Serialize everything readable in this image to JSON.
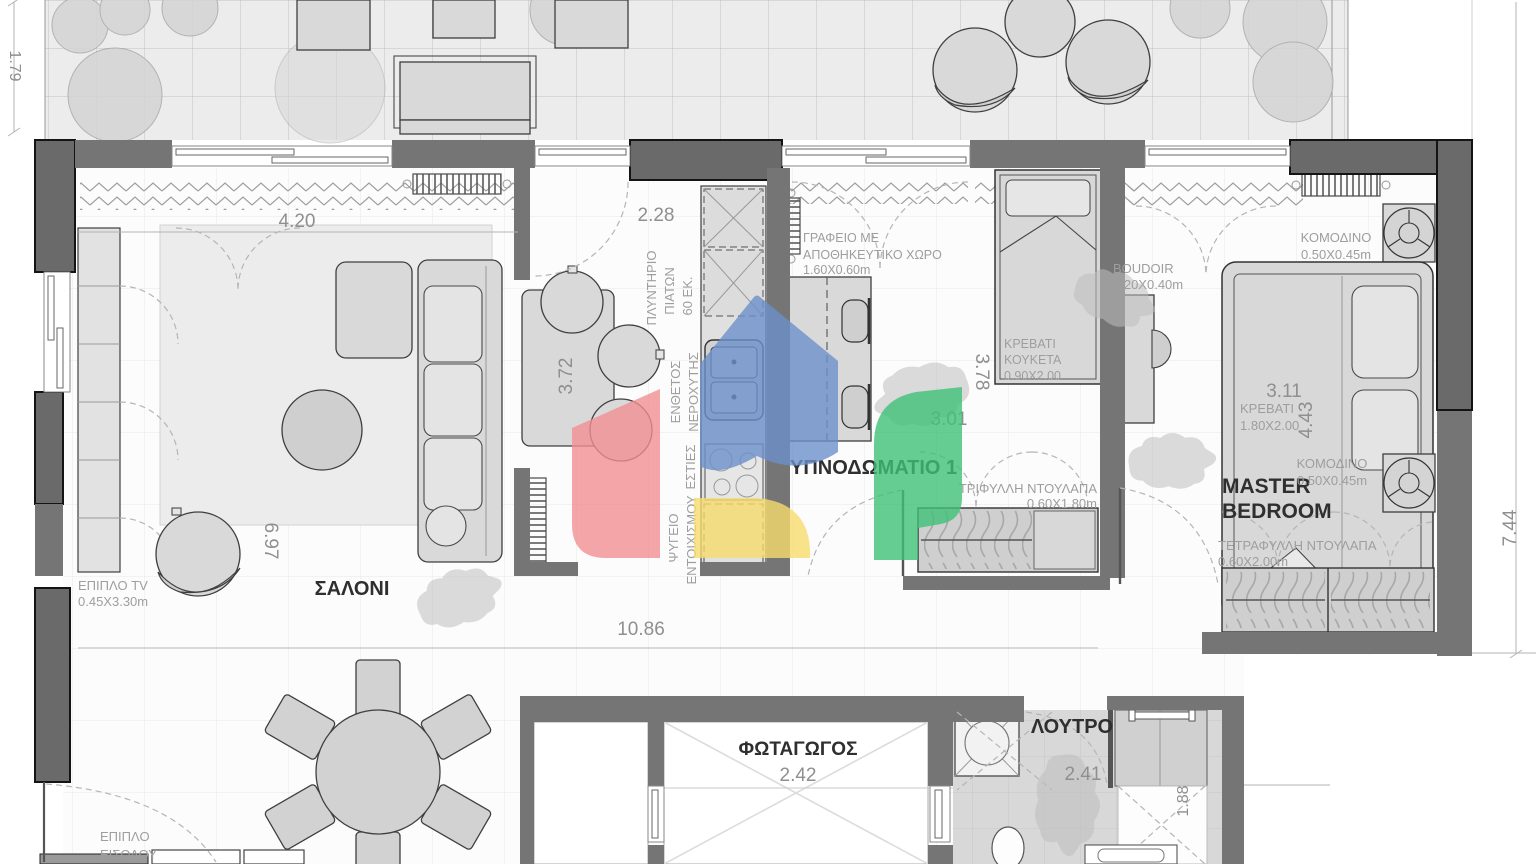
{
  "document": {
    "type": "apartment-floor-plan"
  },
  "colors": {
    "wall": "#757575",
    "wall_outlined": "#6a6a6a",
    "furniture": "#d9d9d9",
    "annotation_gray": "#8f8f8f",
    "room_label": "#2f2f2f",
    "logo_blue": "#6b90cb",
    "logo_red": "#f08f92",
    "logo_yellow": "#f6db6d",
    "logo_green": "#3ec077"
  },
  "icons": {
    "logo": "house-watermark",
    "rhino": "rhino-watermark"
  },
  "rooms": {
    "living": "ΣΑΛΟΝΙ",
    "bedroom1": "ΥΠΝΟΔΩΜΑΤΙΟ 1",
    "master_line1": "MASTER",
    "master_line2": "BEDROOM",
    "bathroom": "ΛΟΥΤΡΟ",
    "lightwell": "ΦΩΤΑΓΩΓΟΣ"
  },
  "dimensions": {
    "left_height": "1.79",
    "living_width": "4.20",
    "living_height": "6.97",
    "kitchen_width": "2.28",
    "kitchen_height": "3.72",
    "bedroom1_height": "3.78",
    "bedroom1_width": "3.01",
    "master_width": "3.11",
    "master_height": "4.43",
    "right_height": "7.44",
    "corridor_width": "10.86",
    "lightwell_width": "2.42",
    "bathroom_width": "2.41",
    "bathroom_height": "1.88"
  },
  "furniture_labels": {
    "tv": [
      "ΕΠΙΠΛΟ TV",
      "0.45X3.30m"
    ],
    "dishwasher": [
      "ΠΛΥΝΤΗΡΙΟ",
      "ΠΙΑΤΩΝ",
      "60 ΕΚ."
    ],
    "sink": [
      "ΕΝΘΕΤΟΣ",
      "ΝΕΡΟΧΥΤΗΣ"
    ],
    "hob": [
      "ΕΣΤΙΕΣ"
    ],
    "fridge": [
      "ΨΥΓΕΙΟ",
      "ΕΝΤΟΙΧΙΣΜΟΥ"
    ],
    "desk": [
      "ΓΡΑΦΕΙΟ ΜΕ",
      "ΑΠΟΘΗΚΕΥΤΙΚΟ ΧΩΡΟ",
      "1.60X0.60m"
    ],
    "bunk_bed": [
      "ΚΡΕΒΑΤΙ",
      "ΚΟΥΚΕΤΑ",
      "0.90X2.00"
    ],
    "wardrobe_3door": [
      "ΤΡΙΦΥΛΛΗ ΝΤΟΥΛΑΠΑ",
      "0.60X1.80m"
    ],
    "boudoir": [
      "BOUDOIR",
      "1.20X0.40m"
    ],
    "nightstand": [
      "ΚΟΜΟΔΙΝΟ",
      "0.50X0.45m"
    ],
    "master_bed": [
      "ΚΡΕΒΑΤΙ",
      "1.80X2.00"
    ],
    "wardrobe_4door": [
      "ΤΕΤΡΑΦΥΛΛΗ ΝΤΟΥΛΑΠΑ",
      "0.60X2.00m"
    ],
    "entrance_unit": [
      "ΕΠΙΠΛΟ",
      "ΕΙΣΟΔΟΥ",
      "0.30X1.00m"
    ]
  }
}
